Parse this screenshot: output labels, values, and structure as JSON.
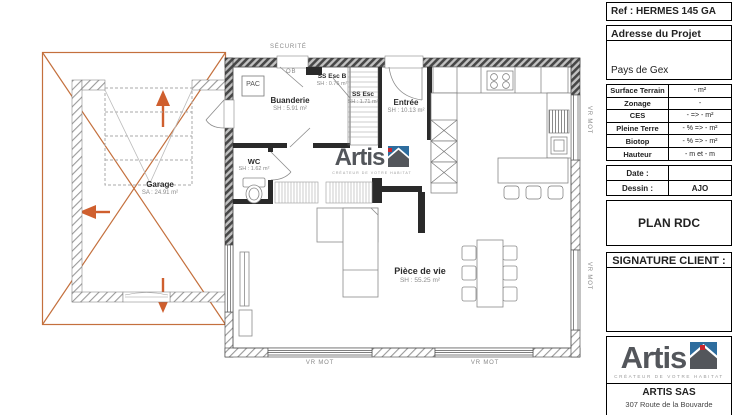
{
  "title_block": {
    "ref": "Ref : HERMES 145 GA",
    "address": {
      "label": "Adresse du Projet",
      "value": "Pays de Gex"
    },
    "site_info": {
      "rows": [
        {
          "label": "Surface Terrain",
          "value": "- m²"
        },
        {
          "label": "Zonage",
          "value": "-"
        },
        {
          "label": "CES",
          "value": "- => - m²"
        },
        {
          "label": "Pleine Terre",
          "value": "- % => - m²"
        },
        {
          "label": "Biotop",
          "value": "- % => - m²"
        },
        {
          "label": "Hauteur",
          "value": "- m et - m"
        }
      ]
    },
    "meta": {
      "rows": [
        {
          "label": "Date :",
          "value": ""
        },
        {
          "label": "Dessin :",
          "value": "AJO"
        }
      ]
    },
    "plan_title": "PLAN RDC",
    "signature_label": "SIGNATURE CLIENT :",
    "company": {
      "logo_text": "Artis",
      "tagline": "CRÉATEUR DE VOTRE HABITAT",
      "name": "ARTIS SAS",
      "address_line": "307 Route de la Bouvarde"
    }
  },
  "plan": {
    "rooms": {
      "garage": {
        "name": "Garage",
        "area": "SA : 24.91 m²"
      },
      "buanderie": {
        "name": "Buanderie",
        "area": "SH : 5.91 m²"
      },
      "wc": {
        "name": "WC",
        "area": "SH : 1.62 m²"
      },
      "ss_esc_b": {
        "name": "SS Esc B",
        "area": "SH : 0.76 m²"
      },
      "ss_esc": {
        "name": "SS Esc",
        "area": "SH : 1.71 m²"
      },
      "entree": {
        "name": "Entrée",
        "area": "SH : 10.13 m²"
      },
      "piece_de_vie": {
        "name": "Pièce de vie",
        "area": "SH : 55.25 m²"
      }
    },
    "annotations": {
      "securite": "SÉCURITÉ",
      "ob": "OB",
      "pac": "PAC",
      "vr_mot": "VR MOT"
    },
    "watermark": {
      "logo_text": "Artis",
      "tagline": "CRÉATEUR DE VOTRE HABITAT"
    }
  },
  "colors": {
    "annotation_orange": "#c4703d",
    "arrow_orange": "#cf5f2e",
    "logo_slate": "#53565b",
    "logo_red": "#c9252c",
    "logo_blue": "#2e6d9e"
  }
}
